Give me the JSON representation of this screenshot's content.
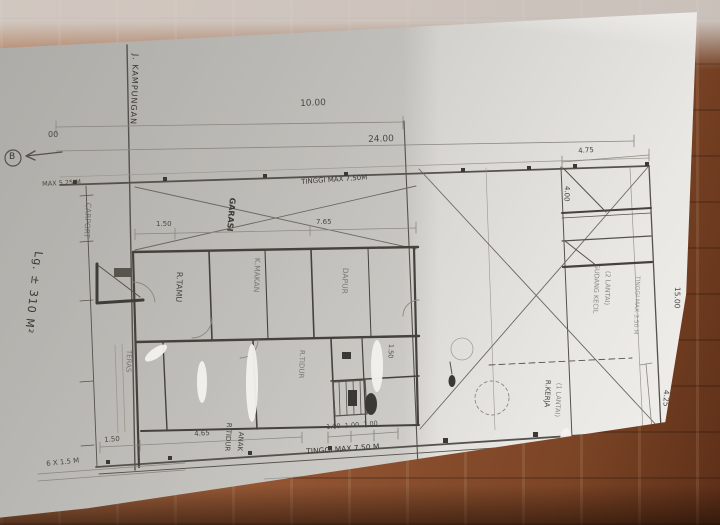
{
  "colors": {
    "paper": "#d6d4d0",
    "pencil_ink": "#4a4843",
    "pencil_faint": "#8d8b85",
    "wood": "#935634",
    "whiteout": "#f3f2ef"
  },
  "ann": {
    "section_b": "B",
    "street": "J. KAMPUNGAN",
    "area_note": "Lg. ± 310 M²",
    "dim_partial": "00",
    "dim_10": "10.00",
    "dim_24": "24.00",
    "max_525": "MAX 5.25 M",
    "tinggi_top": "TINGGI MAX 7.50M",
    "tinggi_bottom": "TINGGI MAX 7.50 M",
    "dim_150_garage": "1.50",
    "dim_765": "7.65",
    "dim_475": "4.75",
    "dim_400": "4.00",
    "dim_1500": "15.00",
    "dim_425": "4.25",
    "note_350": "TINGGI MAX 3.50 M",
    "dim_465": "4.65",
    "dim_150_left": "1.50",
    "dim_100_row": "1.00  1.00  1.00",
    "dim_6x15": "6 X 1.5 M",
    "dim_150_inner": "1.50",
    "dim_1250": "12.50"
  },
  "rooms": {
    "carport": "CARPORT",
    "garage": "GARASI",
    "living": "R.TAMU",
    "dining": "K.MAKAN",
    "kitchen": "DAPUR",
    "terrace": "TERAS",
    "bedroom": "R.TIDUR",
    "kids_bedroom_1": "R.TIDUR",
    "kids_bedroom_2": "ANAK",
    "workroom_1": "R.KERJA",
    "workroom_2": "(1 LANTAI)",
    "storage_1": "GUDANG KECIL",
    "storage_2": "(2 LANTAI)"
  }
}
